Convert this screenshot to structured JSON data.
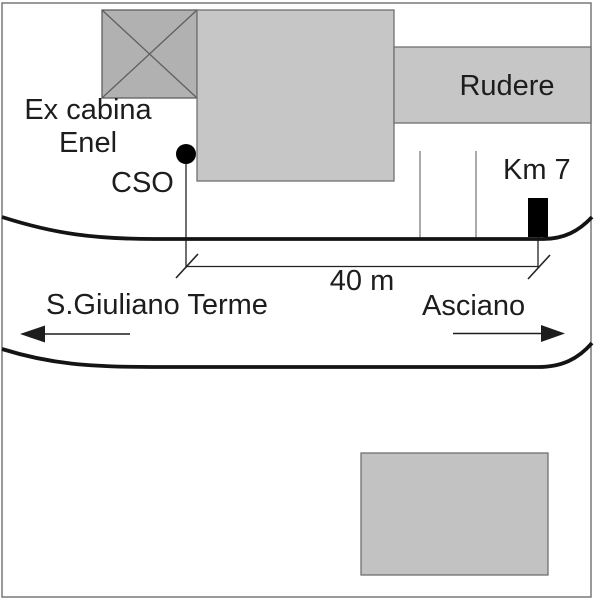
{
  "diagram": {
    "kind": "site-location-sketch",
    "labels": {
      "ex_cabina_line1": "Ex cabina",
      "ex_cabina_line2": "Enel",
      "cso": "CSO",
      "rudere": "Rudere",
      "km_marker": "Km 7",
      "distance": "40 m",
      "destination_left": "S.Giuliano Terme",
      "destination_right": "Asciano"
    },
    "colors": {
      "background": "#ffffff",
      "building_fill": "#c6c6c6",
      "crossed_box_fill": "#b1b1b1",
      "bottom_building_fill": "#c2c2c2",
      "outline_gray": "#6f6f6f",
      "road_black": "#141414",
      "marker_black": "#000000",
      "ink": "#1d1d1d"
    }
  }
}
